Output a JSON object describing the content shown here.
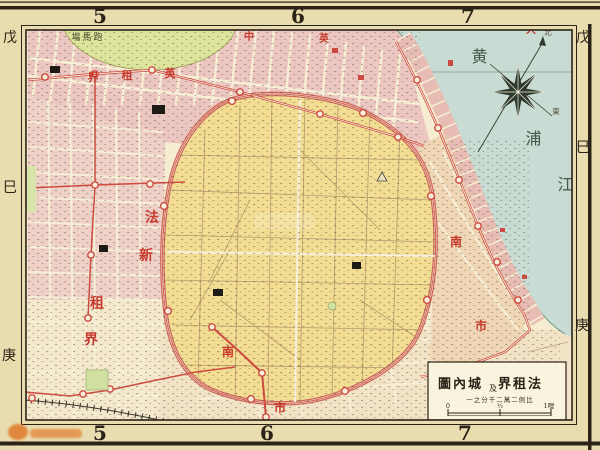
{
  "grid": {
    "top": [
      "5",
      "6",
      "7"
    ],
    "bottom": [
      "5",
      "6",
      "7"
    ],
    "left": [
      "戊",
      "巳",
      "庚"
    ],
    "right": [
      "戊",
      "巳",
      "庚"
    ]
  },
  "water": {
    "name_chars": [
      "黄",
      "浦",
      "江"
    ],
    "name_reading": "黄浦江"
  },
  "compass": {
    "north": "北",
    "east": "東",
    "icon": "compass-rose-8-point-star"
  },
  "racecourse": {
    "label_display": "塲馬跑",
    "label_reading": "跑馬塲"
  },
  "regions": {
    "british_boundary": {
      "display_chars": [
        "界",
        "租",
        "英"
      ],
      "reading": "英租界"
    },
    "top_edge_chars": [
      "中",
      "英",
      "大"
    ],
    "french_new": {
      "display_chars": [
        "法",
        "新",
        "租",
        "界"
      ],
      "reading": "法新租界"
    },
    "nanshi_east": {
      "display_chars": [
        "南",
        "市"
      ],
      "reading": "南市"
    },
    "nanshi_south": {
      "display_chars": [
        "南",
        "市"
      ],
      "reading": "南市"
    }
  },
  "cartouche": {
    "title_parts": [
      "圖內城",
      "及",
      "界租法"
    ],
    "title_reading": "法租界及城內圖",
    "scale_display": "一之分千二萬二例比",
    "scale_reading": "比例二萬二千分之一",
    "scalebar": {
      "zero": "0",
      "half": "½",
      "mile": "1哩"
    }
  },
  "colors": {
    "paper": "#e9dcae",
    "map_bg": "#f6ecd2",
    "water": "#c9dcd4",
    "city_yellow": "#f3dd92",
    "concession_pink": "#ecc6c0",
    "racecourse_green": "#dde49c",
    "red_line": "#cc4a40",
    "red_text": "#c63a2e",
    "frame": "#2b2218"
  }
}
